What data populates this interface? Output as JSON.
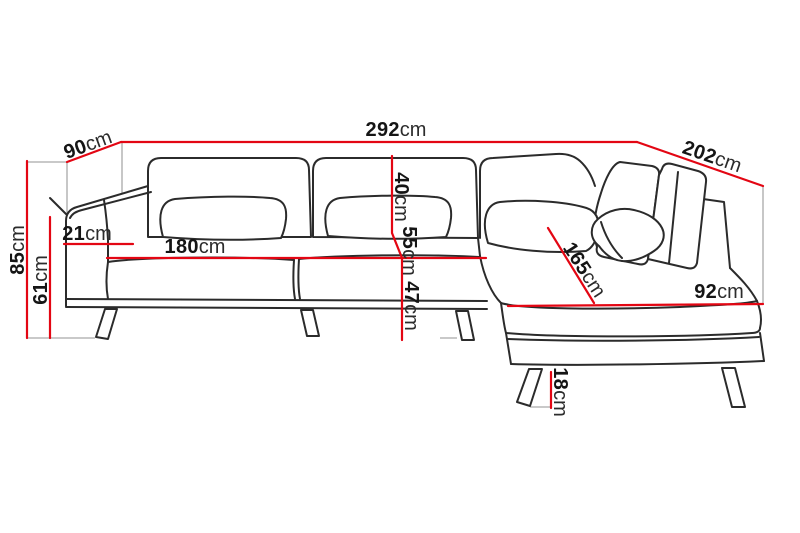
{
  "diagram": {
    "type": "furniture-dimension-drawing",
    "subject": "corner-sofa-with-chaise",
    "unit": "cm",
    "colors": {
      "dimension_line": "#e30613",
      "outline": "#2b2b2b",
      "guide_line": "#a9a9a9",
      "background": "#ffffff",
      "label_text": "#151515"
    },
    "dimensions": {
      "total_width": {
        "value": "292",
        "unit": "cm"
      },
      "left_depth": {
        "value": "90",
        "unit": "cm"
      },
      "right_depth": {
        "value": "202",
        "unit": "cm"
      },
      "total_height": {
        "value": "85",
        "unit": "cm"
      },
      "arm_height": {
        "value": "61",
        "unit": "cm"
      },
      "arm_width": {
        "value": "21",
        "unit": "cm"
      },
      "seat_width": {
        "value": "180",
        "unit": "cm"
      },
      "backrest_height": {
        "value": "40",
        "unit": "cm"
      },
      "seat_depth": {
        "value": "55",
        "unit": "cm"
      },
      "seat_height": {
        "value": "47",
        "unit": "cm"
      },
      "chaise_length": {
        "value": "165",
        "unit": "cm"
      },
      "chaise_width": {
        "value": "92",
        "unit": "cm"
      },
      "leg_height": {
        "value": "18",
        "unit": "cm"
      }
    }
  }
}
